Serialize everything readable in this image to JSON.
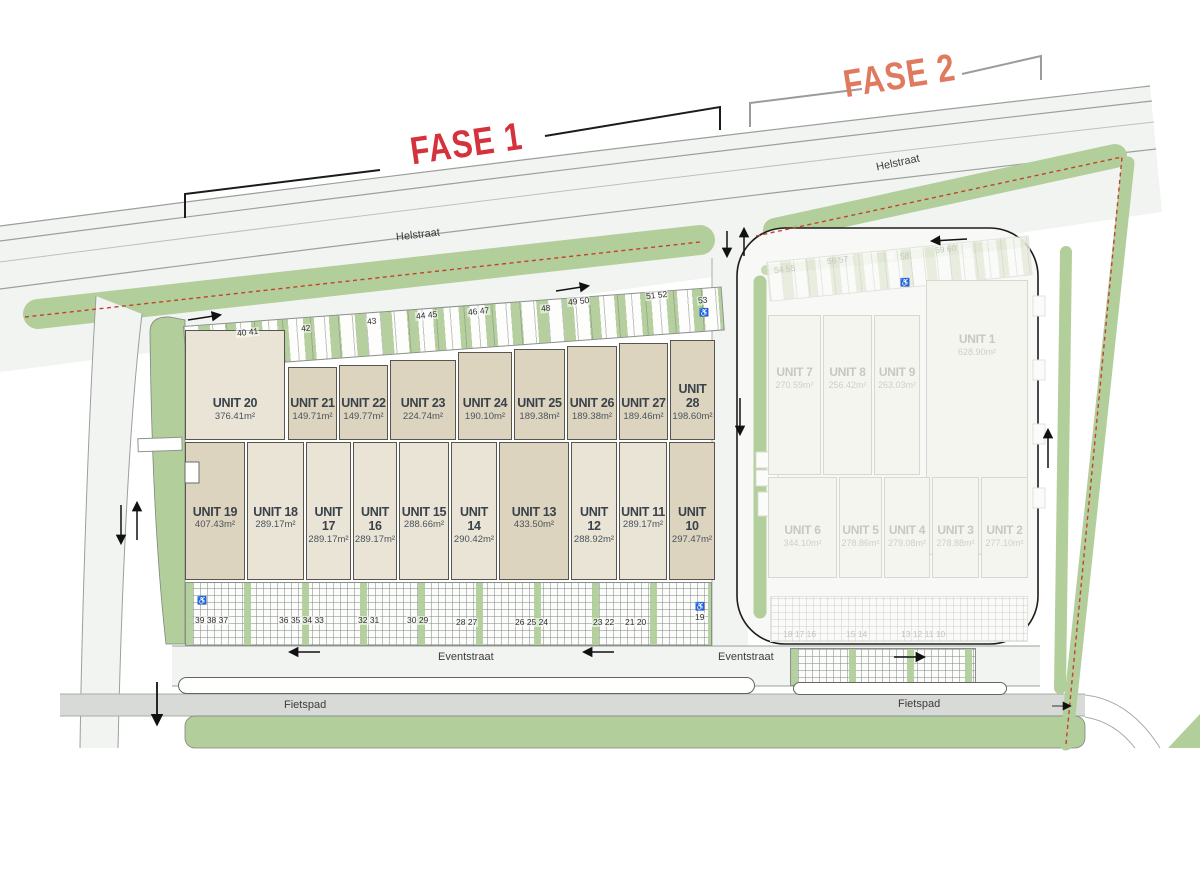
{
  "phase_labels": {
    "fase1": "FASE 1",
    "fase2": "FASE 2"
  },
  "street_labels": {
    "helstraat_left": "Helstraat",
    "helstraat_right": "Helstraat",
    "eventstraat_left": "Eventstraat",
    "eventstraat_right": "Eventstraat",
    "fietspad_left": "Fietspad",
    "fietspad_right": "Fietspad"
  },
  "colors": {
    "fase1_label": "#d4323c",
    "fase2_label": "#e07a5f",
    "green": "#b2cf9b",
    "unit_beige_dark": "#dcd4bf",
    "unit_beige_light": "#e9e4d6",
    "boundary_dash_red": "#c6402f"
  },
  "icons": {
    "disabled_parking": "♿"
  },
  "fase1": {
    "top_units": [
      {
        "name": "UNIT 20",
        "area": "376.41m²"
      },
      {
        "name": "UNIT 21",
        "area": "149.71m²"
      },
      {
        "name": "UNIT 22",
        "area": "149.77m²"
      },
      {
        "name": "UNIT 23",
        "area": "224.74m²"
      },
      {
        "name": "UNIT 24",
        "area": "190.10m²"
      },
      {
        "name": "UNIT 25",
        "area": "189.38m²"
      },
      {
        "name": "UNIT 26",
        "area": "189.38m²"
      },
      {
        "name": "UNIT 27",
        "area": "189.46m²"
      },
      {
        "name": "UNIT 28",
        "area": "198.60m²"
      }
    ],
    "bottom_units": [
      {
        "name": "UNIT 19",
        "area": "407.43m²"
      },
      {
        "name": "UNIT 18",
        "area": "289.17m²"
      },
      {
        "name": "UNIT 17",
        "area": "289.17m²"
      },
      {
        "name": "UNIT 16",
        "area": "289.17m²"
      },
      {
        "name": "UNIT 15",
        "area": "288.66m²"
      },
      {
        "name": "UNIT 14",
        "area": "290.42m²"
      },
      {
        "name": "UNIT 13",
        "area": "433.50m²"
      },
      {
        "name": "UNIT 12",
        "area": "288.92m²"
      },
      {
        "name": "UNIT 11",
        "area": "289.17m²"
      },
      {
        "name": "UNIT 10",
        "area": "297.47m²"
      }
    ],
    "parking_top": [
      "40 41",
      "42",
      "43",
      "44 45",
      "46 47",
      "48",
      "49 50",
      "51 52",
      "53"
    ],
    "parking_bottom": [
      "39 38 37",
      "36 35 34 33",
      "32 31",
      "30 29",
      "28 27",
      "26 25 24",
      "23 22",
      "21 20",
      "19"
    ]
  },
  "fase2": {
    "unit1": {
      "name": "UNIT 1",
      "area": "628.90m²"
    },
    "top_units": [
      {
        "name": "UNIT 7",
        "area": "270.59m²"
      },
      {
        "name": "UNIT 8",
        "area": "256.42m²"
      },
      {
        "name": "UNIT 9",
        "area": "263.03m²"
      }
    ],
    "bottom_units": [
      {
        "name": "UNIT 6",
        "area": "344.10m²"
      },
      {
        "name": "UNIT 5",
        "area": "278.86m²"
      },
      {
        "name": "UNIT 4",
        "area": "279.08m²"
      },
      {
        "name": "UNIT 3",
        "area": "278.88m²"
      },
      {
        "name": "UNIT 2",
        "area": "277.10m²"
      }
    ],
    "parking_top": [
      "54 55",
      "56 57",
      "58",
      "59 60"
    ],
    "parking_bottom": [
      "18 17 16",
      "15 14",
      "13 12 11 10"
    ]
  }
}
